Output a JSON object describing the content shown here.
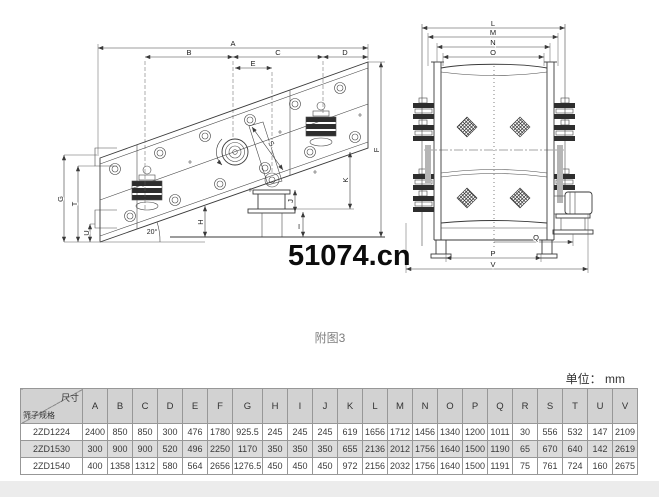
{
  "page": {
    "watermark": "51074.cn",
    "figure_caption": "附图3",
    "unit_label": "单位： mm"
  },
  "diagrams": {
    "left": {
      "description": "vibrating-screen side view, inclined body",
      "angle_label": "20°",
      "labels": {
        "A": "A",
        "B": "B",
        "C": "C",
        "D": "D",
        "E": "E",
        "F": "F",
        "G": "G",
        "H": "H",
        "I": "I",
        "J": "J",
        "K": "K",
        "S": "S",
        "T": "T",
        "U": "U"
      }
    },
    "right": {
      "description": "vibrating-screen end view with mesh panels",
      "labels": {
        "L": "L",
        "M": "M",
        "N": "N",
        "O": "O",
        "P": "P",
        "Q": "Q",
        "V": "V"
      }
    }
  },
  "table": {
    "corner": {
      "top_right": "尺寸",
      "bottom_left": "筛子规格"
    },
    "columns": [
      "A",
      "B",
      "C",
      "D",
      "E",
      "F",
      "G",
      "H",
      "I",
      "J",
      "K",
      "L",
      "M",
      "N",
      "O",
      "P",
      "Q",
      "R",
      "S",
      "T",
      "U",
      "V"
    ],
    "rows": [
      {
        "model": "2ZD1224",
        "shaded": false,
        "values": [
          "2400",
          "850",
          "850",
          "300",
          "476",
          "1780",
          "925.5",
          "245",
          "245",
          "245",
          "619",
          "1656",
          "1712",
          "1456",
          "1340",
          "1200",
          "1011",
          "30",
          "556",
          "532",
          "147",
          "2109"
        ]
      },
      {
        "model": "2ZD1530",
        "shaded": true,
        "values": [
          "300",
          "900",
          "900",
          "520",
          "496",
          "2250",
          "1170",
          "350",
          "350",
          "350",
          "655",
          "2136",
          "2012",
          "1756",
          "1640",
          "1500",
          "1190",
          "65",
          "670",
          "640",
          "142",
          "2619"
        ]
      },
      {
        "model": "2ZD1540",
        "shaded": false,
        "values": [
          "400",
          "1358",
          "1312",
          "580",
          "564",
          "2656",
          "1276.5",
          "450",
          "450",
          "450",
          "972",
          "2156",
          "2032",
          "1756",
          "1640",
          "1500",
          "1191",
          "75",
          "761",
          "724",
          "160",
          "2675"
        ]
      }
    ]
  },
  "colors": {
    "line": "#3a3a3a",
    "table_header_bg": "#d2d2d2",
    "table_shaded_row_bg": "#dcdcdc",
    "table_border": "#979797",
    "caption_gray": "#7d7d7d"
  }
}
